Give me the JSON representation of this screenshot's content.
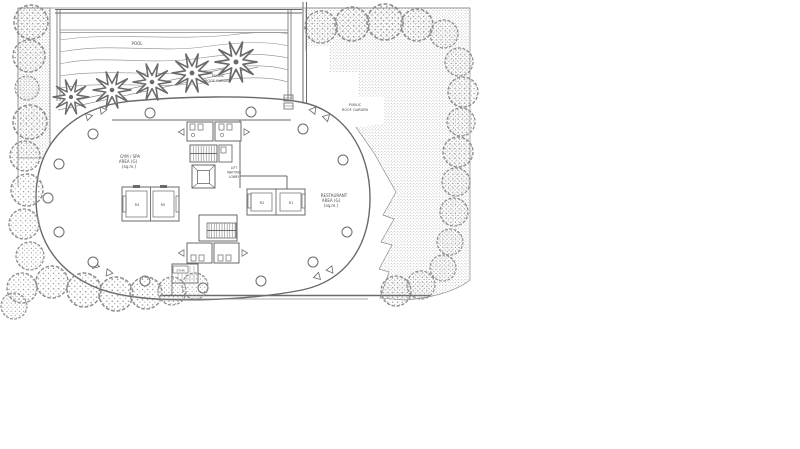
{
  "drawing": {
    "type": "architectural-floor-plan",
    "labels": {
      "pool": "POOL",
      "garden_upper": [
        "PUBLIC",
        "ROOF GARDEN"
      ],
      "garden_right": [
        "PUBLIC",
        "ROOF GARDEN"
      ],
      "gym": [
        "GYM / SPA",
        "AREA (G)",
        "(sq.m.)"
      ],
      "lift": [
        "LIFT",
        "WAITING",
        "LOBBY"
      ],
      "restaurant": [
        "RESTAURANT",
        "AREA (G)",
        "(sq.m.)"
      ],
      "stair": "STAIR",
      "rooms": {
        "left_a": "R4",
        "left_b": "R5",
        "right_a": "R2",
        "right_b": "R1"
      }
    },
    "colors": {
      "line": "#6a6a6a",
      "thin_line": "#8c8c8c",
      "stipple_dot": "#909090",
      "text": "#4a4a4a",
      "background": "#ffffff"
    }
  }
}
